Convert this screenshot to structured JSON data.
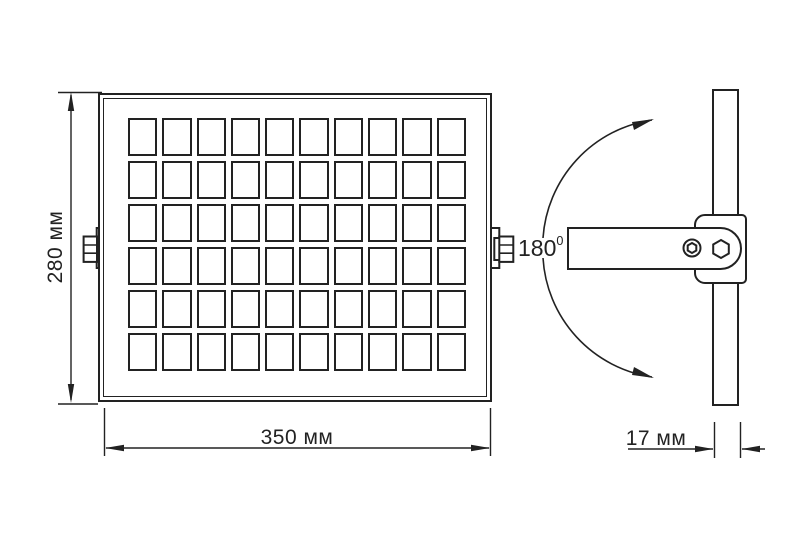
{
  "title": "Floodlight dimensional drawing",
  "dimensions": {
    "height": {
      "value": "280",
      "unit": "мм",
      "label": "280 мм"
    },
    "width": {
      "value": "350",
      "unit": "мм",
      "label": "350 мм"
    },
    "depth": {
      "value": "17",
      "unit": "мм",
      "label": "17 мм"
    }
  },
  "rotation": {
    "value": "180",
    "sup": "0"
  },
  "solar_panel_grid": {
    "columns": 10,
    "rows": 6
  },
  "colors": {
    "line": "#222222",
    "background": "#ffffff"
  }
}
